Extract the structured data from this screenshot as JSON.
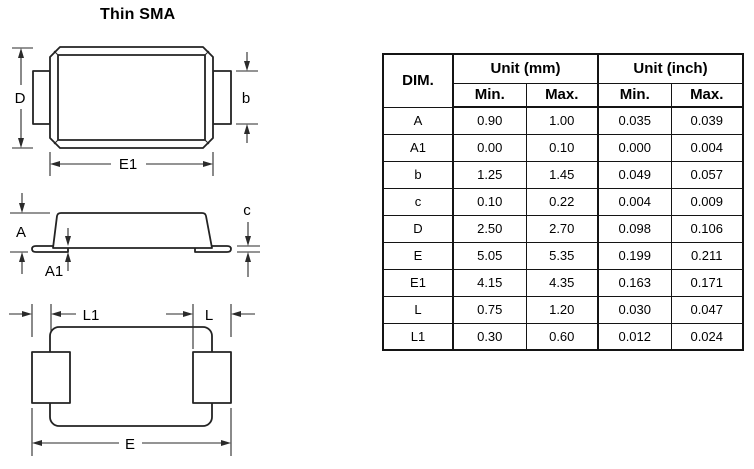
{
  "page": {
    "title": "Thin SMA"
  },
  "diagram": {
    "labels": {
      "d": "D",
      "e1": "E1",
      "b": "b",
      "a": "A",
      "a1": "A1",
      "c": "c",
      "l1": "L1",
      "l": "L",
      "e": "E"
    }
  },
  "table": {
    "header": {
      "dim": "DIM.",
      "unit_mm": "Unit (mm)",
      "unit_inch": "Unit (inch)",
      "min": "Min.",
      "max": "Max."
    },
    "rows": [
      {
        "dim": "A",
        "mm_min": "0.90",
        "mm_max": "1.00",
        "in_min": "0.035",
        "in_max": "0.039"
      },
      {
        "dim": "A1",
        "mm_min": "0.00",
        "mm_max": "0.10",
        "in_min": "0.000",
        "in_max": "0.004"
      },
      {
        "dim": "b",
        "mm_min": "1.25",
        "mm_max": "1.45",
        "in_min": "0.049",
        "in_max": "0.057"
      },
      {
        "dim": "c",
        "mm_min": "0.10",
        "mm_max": "0.22",
        "in_min": "0.004",
        "in_max": "0.009"
      },
      {
        "dim": "D",
        "mm_min": "2.50",
        "mm_max": "2.70",
        "in_min": "0.098",
        "in_max": "0.106"
      },
      {
        "dim": "E",
        "mm_min": "5.05",
        "mm_max": "5.35",
        "in_min": "0.199",
        "in_max": "0.211"
      },
      {
        "dim": "E1",
        "mm_min": "4.15",
        "mm_max": "4.35",
        "in_min": "0.163",
        "in_max": "0.171"
      },
      {
        "dim": "L",
        "mm_min": "0.75",
        "mm_max": "1.20",
        "in_min": "0.030",
        "in_max": "0.047"
      },
      {
        "dim": "L1",
        "mm_min": "0.30",
        "mm_max": "0.60",
        "in_min": "0.012",
        "in_max": "0.024"
      }
    ]
  }
}
